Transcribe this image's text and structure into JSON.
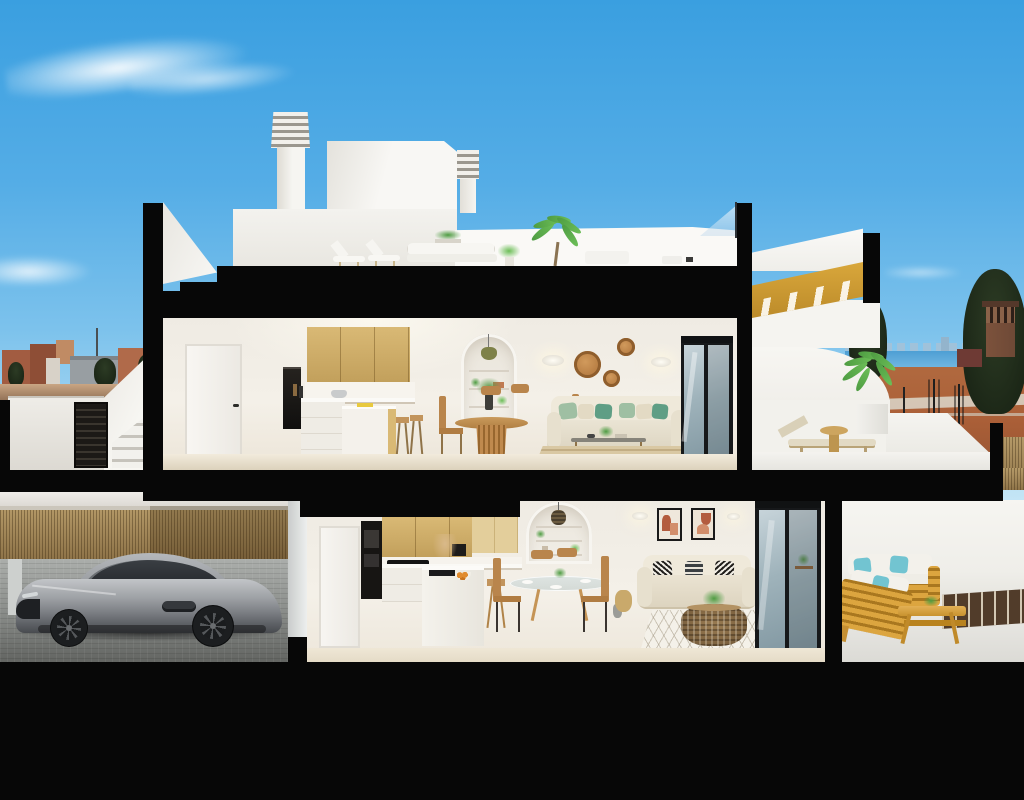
{
  "image_type": "architectural cross-section 3D rendering of a two-storey villa, no text present",
  "colors": {
    "black": "#070707",
    "sky_top": "#3A9FE0",
    "sky_mid": "#7CC2EC",
    "sky_low": "#C8E7F6",
    "white_wall": "#F5F4F0",
    "white_bright": "#FCFBF9",
    "white_shade": "#E2DFD8",
    "interior_wall": "#F1EDE5",
    "floor_beige": "#EAE3D2",
    "wood_cabinet": "#D9B975",
    "wood_dark": "#C2A05C",
    "golden_wood": "#D9A73B",
    "oven_black": "#1B1916",
    "stool_wood": "#C2945C",
    "chair_wood": "#B9854C",
    "rattan": "#BC8247",
    "wicker": "#8C7049",
    "sofa_beige": "#E7E0CF",
    "pillow_sage": "#9FBFA3",
    "pillow_teal": "#5F9E85",
    "pillow_cream": "#E3DAC4",
    "pillow_cyan": "#72C4D1",
    "pillow_charcoal": "#3A3F42",
    "rug_tan": "#D9C8A3",
    "rug_white": "#F4F1E9",
    "glass": "#A9BFCB",
    "frame_dark": "#16181A",
    "art_rust": "#B35C3E",
    "art_terra": "#D28E6B",
    "outdoor_wood": "#DCA53F",
    "cushion_white": "#F3F1EB",
    "walkway": "#513C2A",
    "bamboo": "#A78D5F",
    "paver": "#A4A7A4",
    "car_body": "#9EA1A5",
    "car_window": "#2A2E33",
    "sea": "#4E9FD4",
    "skyline": "#A3C2D8",
    "dirt": "#AC6038",
    "road": "#D9D2C4",
    "tree_dark": "#25311F",
    "palm_green": "#4E9C42",
    "palm_light": "#6CBE57",
    "tower": "#6E4936",
    "town_terra": "#A25C41",
    "town_gray": "#989EA2",
    "louver": "#9B978E",
    "pendant_green": "#7E8148",
    "gate": "#1C1916",
    "fruit_orange": "#E08B2E"
  },
  "scene": {
    "sky": "blue sky with wispy clouds",
    "roof_level": [
      "louvered chimney",
      "stair bulkhead",
      "second chimney",
      "roof terrace with loungers, outdoor sofa, planter, potted palm",
      "glass railing",
      "golden wood stair flight to roof"
    ],
    "upper_floor": [
      "white interior door",
      "kitchen with oak upper cabinets, built-in oven, white island, wooden stools",
      "arched shelf niche with green pendant",
      "round wooden dining table with four chairs",
      "two wall sconces",
      "three rattan wall discs",
      "beige sofa with sage and teal pillows",
      "wood coffee table",
      "striped tan rug",
      "dark framed sliding glass door",
      "terrace with curved white wall, potted palm, sun lounger, round side table"
    ],
    "ground_floor": [
      "garage with silver sports car, bamboo fence, grey paver floor",
      "kitchen with oak cabinets, black oven tower, cooktop, white island with fruit bowl, stool",
      "arched niche with wicker pendant",
      "round glass dining table with four wooden chairs",
      "two framed abstract artworks",
      "beige loveseat with patterned pillows",
      "round wicker coffee table",
      "white diamond rug",
      "sliding glass doors",
      "terrace with teak sofas, aqua pillows, teak bench, dark plank walkway"
    ],
    "exterior": [
      "white side staircase with dark slatted gate",
      "hill town with terracotta houses on the left",
      "sea horizon, distant skyline, cypress trees, watchtower and red earth on the right"
    ]
  }
}
